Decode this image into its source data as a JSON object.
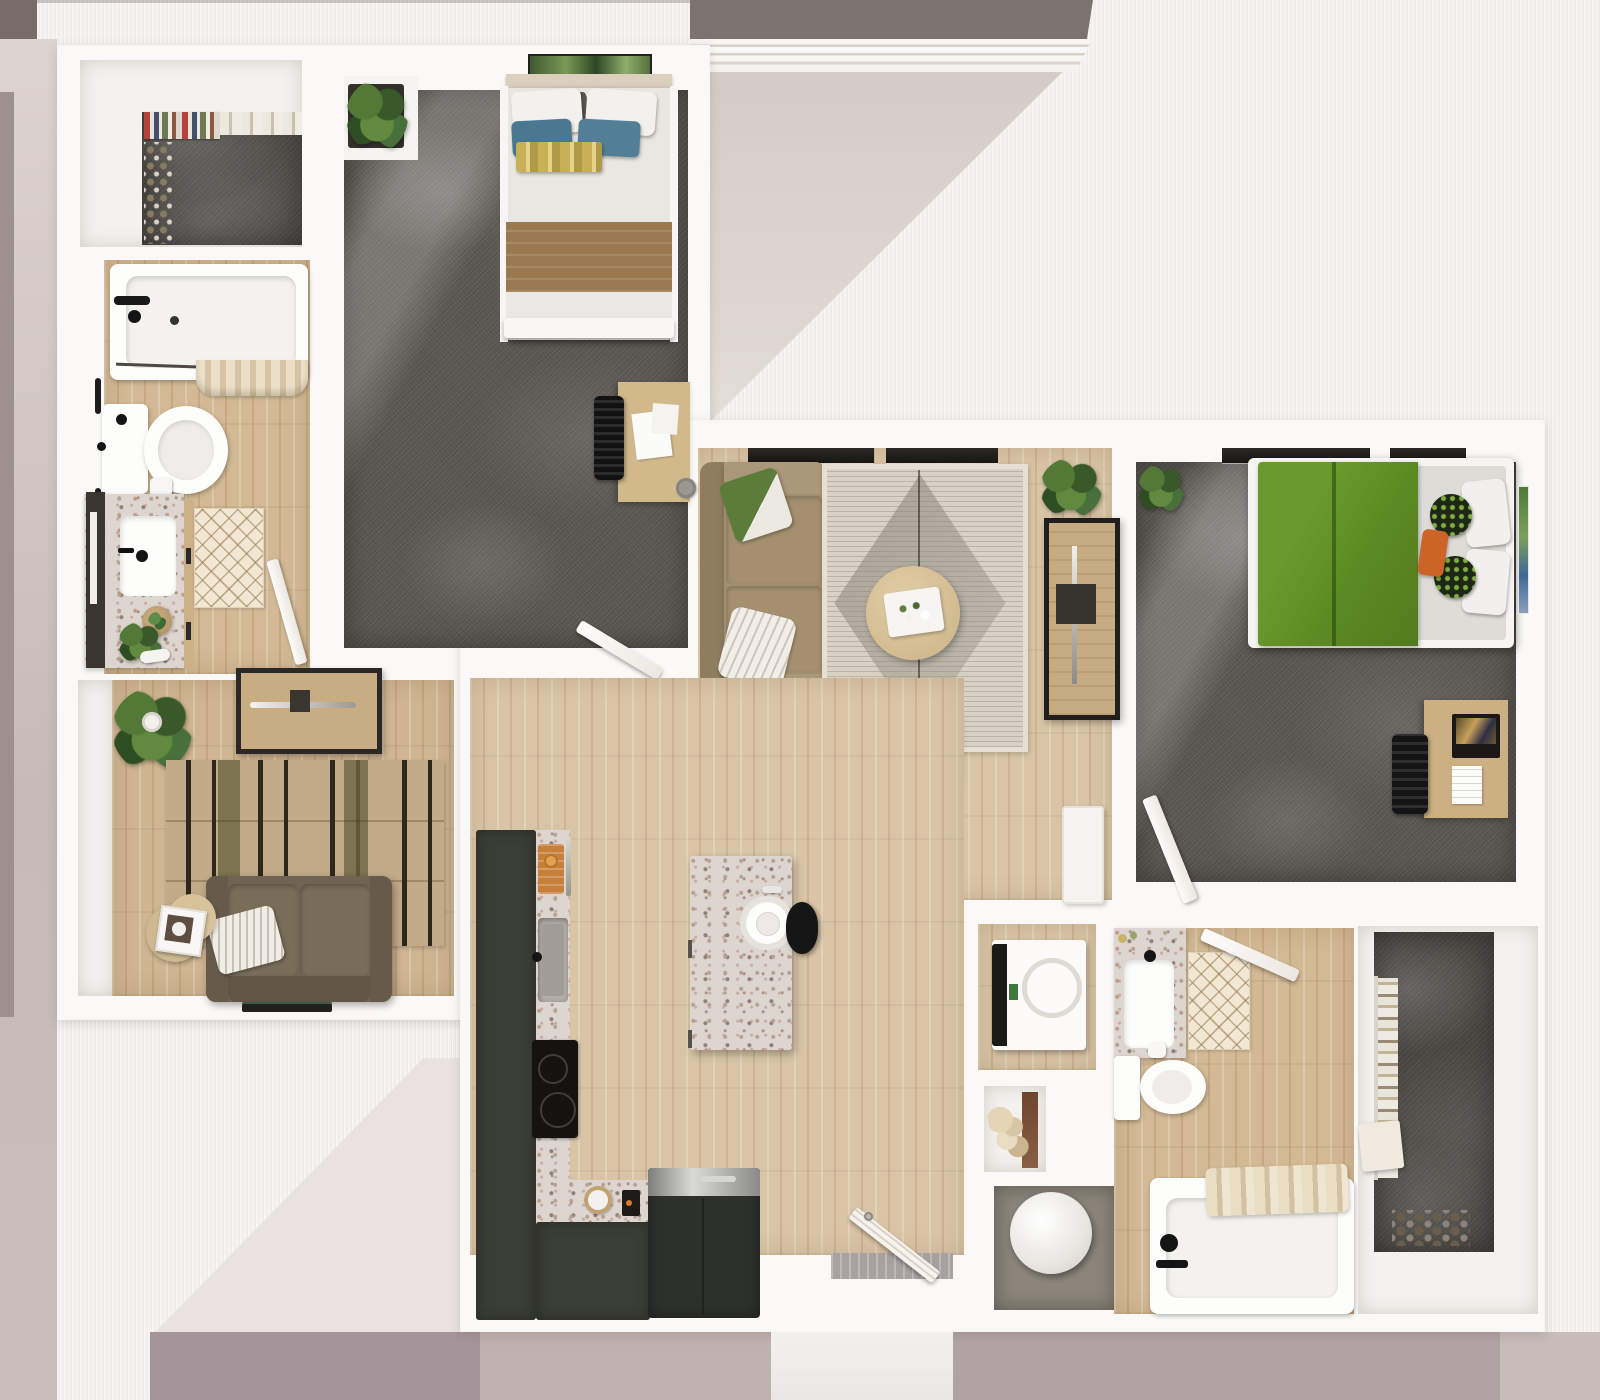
{
  "scene": {
    "type": "3d-floor-plan-rendering",
    "view": "top-down",
    "subject": "two-bedroom two-bathroom apartment with den, open kitchen and living room",
    "visible_text": "none"
  },
  "palette": {
    "backdrop_base": "#f3f0ee",
    "backdrop_taupe_band": "#7c7270",
    "backdrop_mauve_left": "#c7bbb9",
    "backdrop_mauve_bottom": "#a5949a",
    "wall_white": "#faf9f7",
    "wood_floor": "#d9c5a6",
    "carpet_gray": "#5d5954",
    "kitchen_cabinet_dark": "#3b3e36",
    "counter_terrazzo": "#ddd5cf",
    "bed2_duvet_green": "#5c8a22",
    "bed1_blanket_brown": "#9a7950",
    "bed1_pillow_blue": "#4a7890",
    "sofa_tan": "#a28e6e",
    "loveseat_brown": "#6f6352",
    "armchair_blush": "#e4d0c8",
    "window_glass_dark": "#25221f"
  },
  "rooms": [
    {
      "id": "walk-in-closet-1",
      "label": "Walk-in Closet 1",
      "floor": "gray carpet",
      "furniture": [
        "hanging clothes rack",
        "shelf items",
        "shoe row"
      ]
    },
    {
      "id": "bathroom-1",
      "label": "Bathroom 1",
      "floor": "light wood",
      "furniture": [
        "bathtub with faucet",
        "shower curtain",
        "toilet",
        "terrazzo vanity with sink",
        "leaning mirror",
        "diamond bath rug",
        "wood tray",
        "potted plant",
        "towel bars",
        "door"
      ]
    },
    {
      "id": "bedroom-1",
      "label": "Bedroom 1",
      "floor": "gray carpet",
      "furniture": [
        "double bed with white and blue pillows",
        "yellow striped throw",
        "brown blanket",
        "wall art",
        "headboard shelf",
        "planter box",
        "desk with papers",
        "desk chair",
        "door"
      ]
    },
    {
      "id": "den",
      "label": "Den",
      "floor": "light wood",
      "furniture": [
        "media console",
        "striped area rug",
        "brown loveseat",
        "white striped pillow",
        "nesting round side tables with framed photo",
        "potted plant",
        "magazine"
      ]
    },
    {
      "id": "living-room",
      "label": "Living Room",
      "floor": "light wood",
      "furniture": [
        "tan sofa",
        "green pillow",
        "white striped pillow",
        "diamond-pattern area rug",
        "round coffee table with tray and flowers",
        "blush armchair",
        "nesting side tables with plant",
        "tv console with soundbar",
        "potted plants",
        "windows",
        "hall cabinet"
      ]
    },
    {
      "id": "kitchen",
      "label": "Kitchen",
      "floor": "light wood",
      "furniture": [
        "L-shaped dark cabinets",
        "terrazzo countertop",
        "cutting board",
        "kitchen sink",
        "cooktop",
        "prep sink bowl",
        "small appliance",
        "refrigerator",
        "terrazzo island with round sink",
        "black bar stool"
      ]
    },
    {
      "id": "entry",
      "label": "Entry",
      "floor": "light wood",
      "furniture": [
        "louvered entry door",
        "threshold",
        "porch"
      ]
    },
    {
      "id": "hallway",
      "label": "Hallway",
      "floor": "light wood",
      "furniture": [
        "niche shelf with pampas grass"
      ]
    },
    {
      "id": "utility-closet",
      "label": "Utility Closet",
      "floor": "gray concrete",
      "furniture": [
        "water heater tank"
      ]
    },
    {
      "id": "laundry-closet",
      "label": "Laundry Closet",
      "floor": "light wood",
      "furniture": [
        "washer dryer unit"
      ]
    },
    {
      "id": "bathroom-2",
      "label": "Bathroom 2",
      "floor": "light wood",
      "furniture": [
        "terrazzo vanity with sink",
        "soap dishes",
        "diamond bath rug",
        "toilet",
        "toilet paper roll",
        "bathtub with faucet",
        "folded towels",
        "door"
      ]
    },
    {
      "id": "bedroom-2",
      "label": "Bedroom 2",
      "floor": "gray carpet",
      "furniture": [
        "bed with green duvet",
        "patterned pillows",
        "orange lumbar pillow",
        "white pillows",
        "leaning wall art",
        "desk with laptop and paper",
        "desk chair",
        "potted plant",
        "windows",
        "door"
      ]
    },
    {
      "id": "walk-in-closet-2",
      "label": "Walk-in Closet 2",
      "floor": "gray carpet",
      "furniture": [
        "hanging clothes",
        "shoe row",
        "door"
      ]
    }
  ]
}
